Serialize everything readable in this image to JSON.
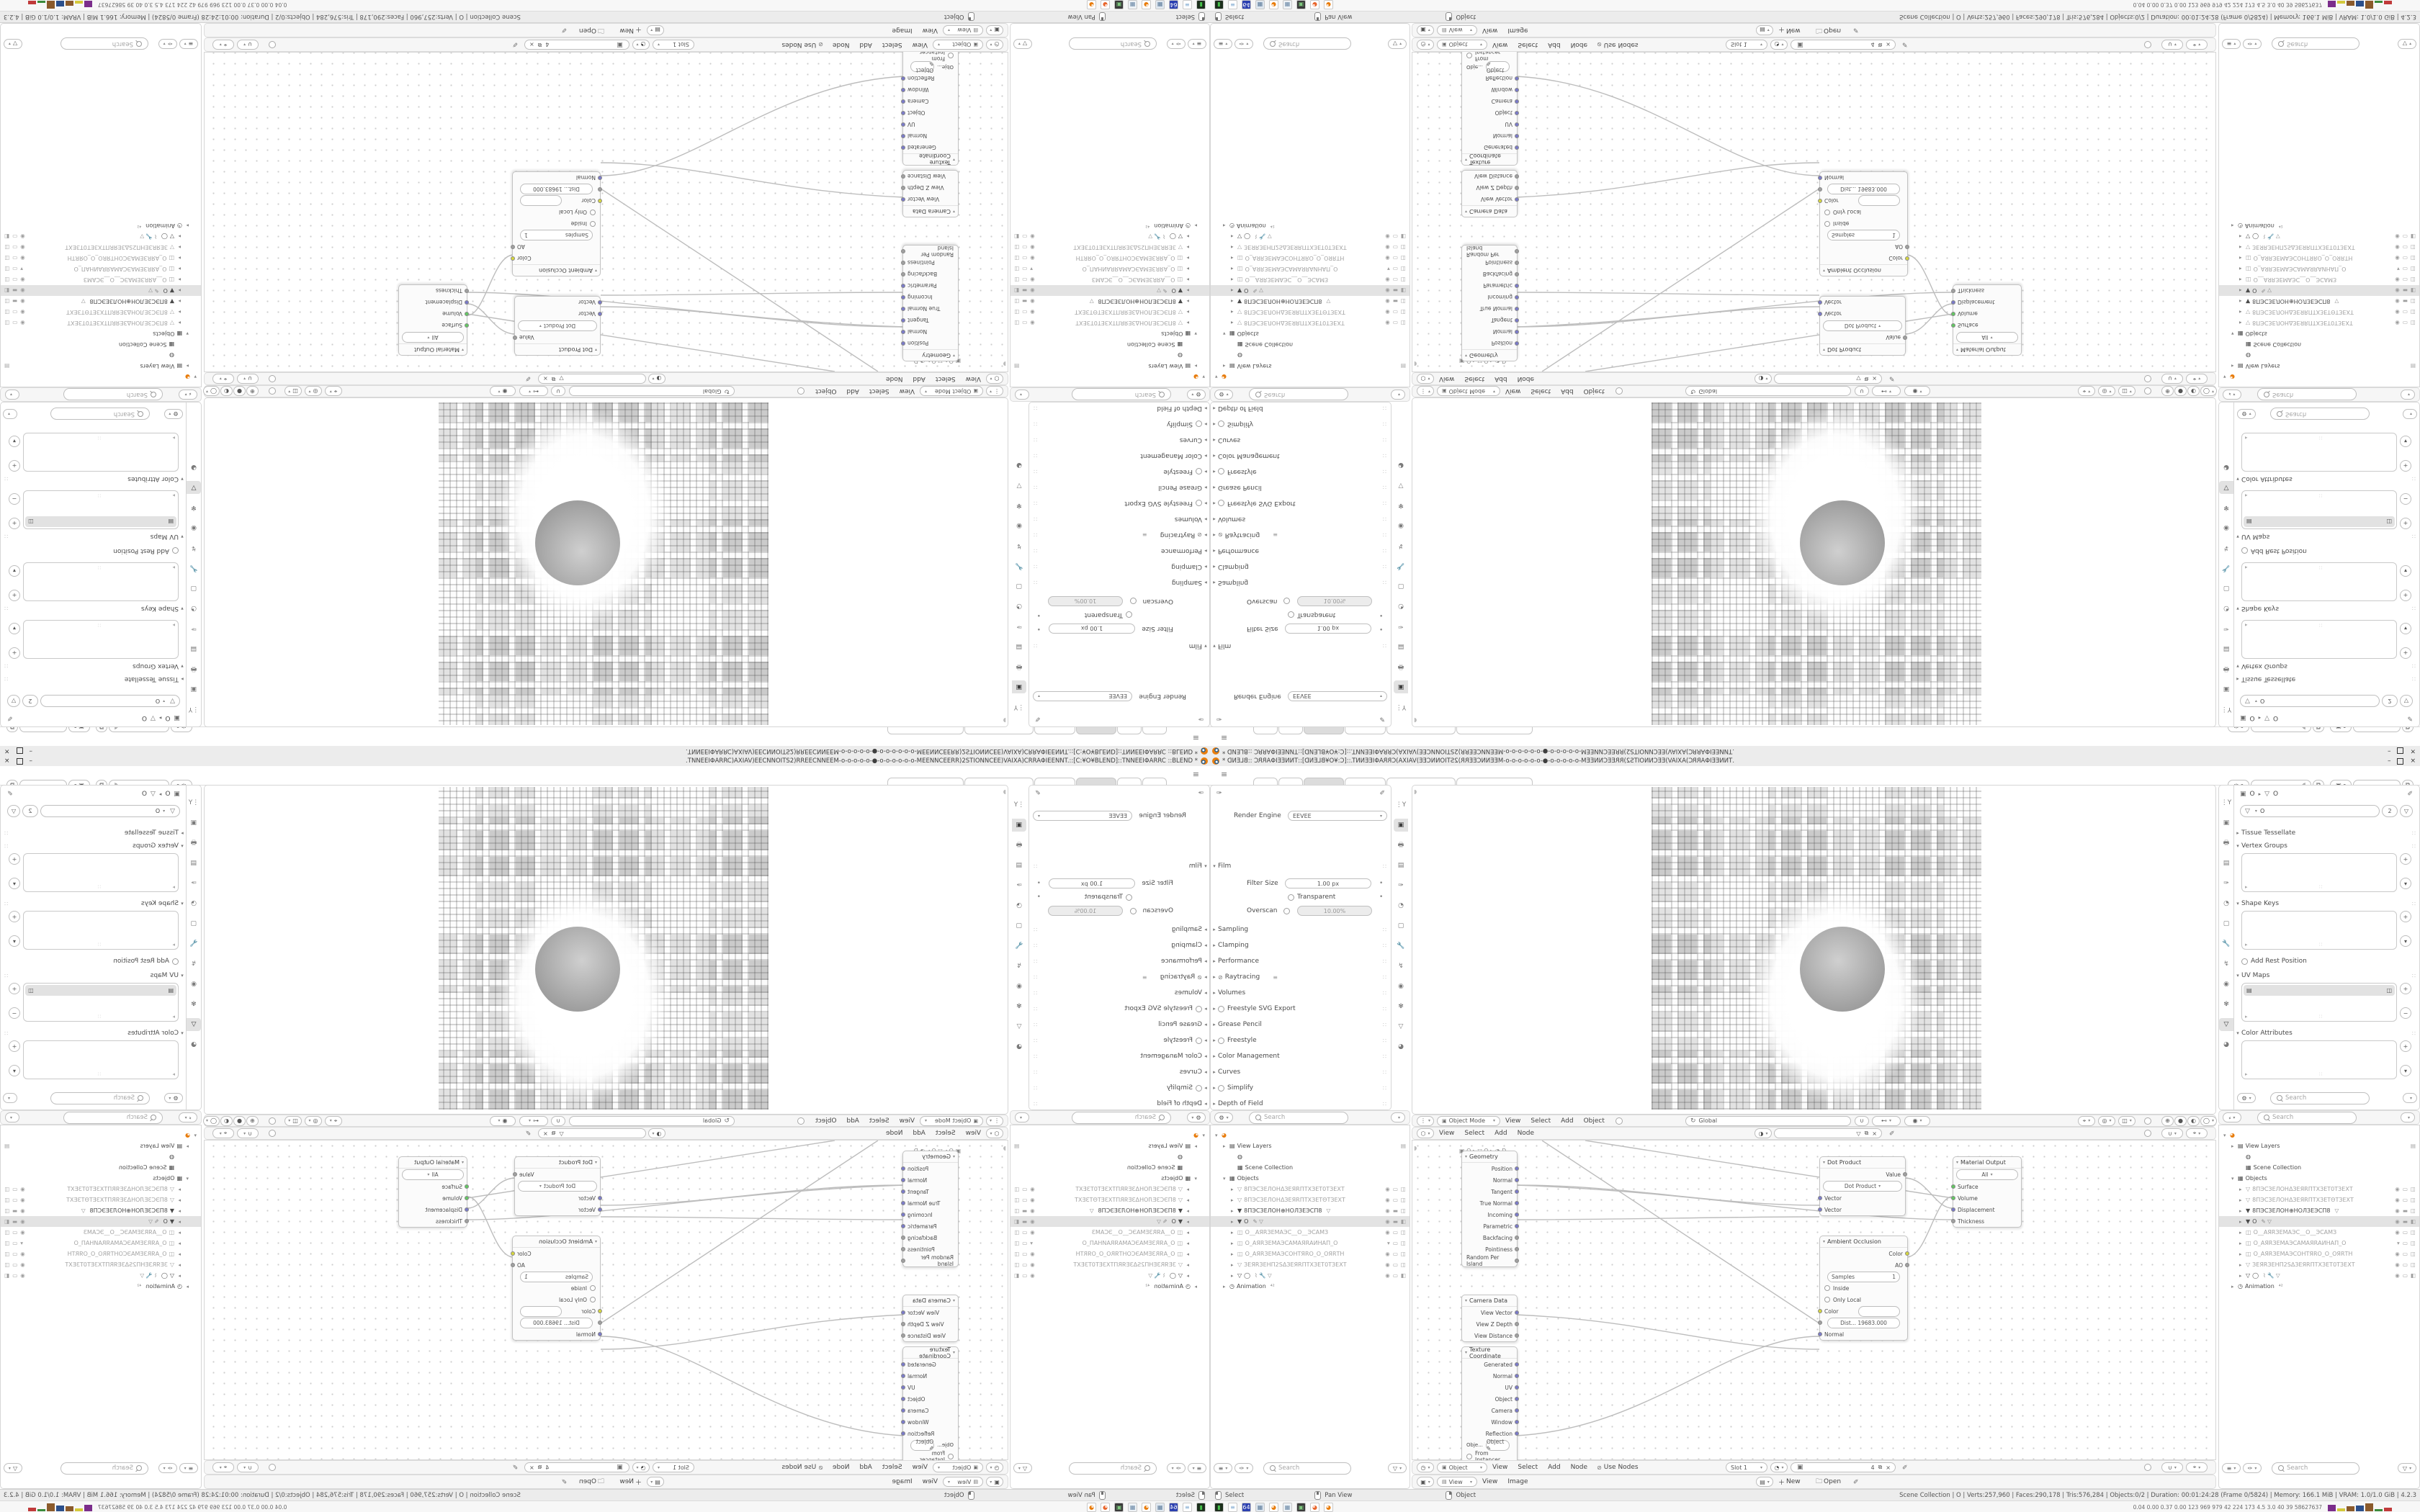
{
  "window": {
    "title_flipped_source": ".TNNEEIΦARRC)AXIAV)EECNNOITS2)RREECNNEEM-o-o-o-o-o-●-o-o-o-o-o-o-MEENNCEERR)2STIONNCEE)VAIXA)CRRAΦIEENNT.::[C:¥O¥BLEND]::TNNEEIΦARRC ::BLEND *",
    "minimize_label": "–",
    "close_label": "×"
  },
  "topbar": {
    "menu_icon": "≡",
    "tabs": {
      "count": 6,
      "active_index": 2,
      "add_label": "+"
    },
    "id_field_1": {
      "icon": "✑",
      "pin": "✐",
      "copy": "⧉"
    },
    "id_field_2": {
      "icon": "▣",
      "copy": "⧉"
    }
  },
  "render_props": {
    "pin_icon": "✐",
    "engine_label": "Render Engine",
    "engine_value": "EEVEE",
    "rows": [
      {
        "t": "open",
        "label": "Film"
      },
      {
        "t": "field",
        "label": "Filter Size",
        "value": "1.00 px"
      },
      {
        "t": "check",
        "label": "Transparent"
      },
      {
        "t": "field2",
        "label": "Overscan",
        "value": "10.00%"
      },
      {
        "t": "panel",
        "label": "Sampling"
      },
      {
        "t": "panel",
        "label": "Clamping"
      },
      {
        "t": "panel",
        "label": "Performance"
      },
      {
        "t": "paneltoggle",
        "label": "Raytracing"
      },
      {
        "t": "panel",
        "label": "Volumes"
      },
      {
        "t": "panelcheck",
        "label": "Freestyle SVG Export"
      },
      {
        "t": "panel",
        "label": "Grease Pencil"
      },
      {
        "t": "panelcheck",
        "label": "Freestyle"
      },
      {
        "t": "panel",
        "label": "Color Management"
      },
      {
        "t": "panel",
        "label": "Curves"
      },
      {
        "t": "panelcheck",
        "label": "Simplify"
      },
      {
        "t": "panel",
        "label": "Depth of Field"
      },
      {
        "t": "panelcheck",
        "label": "Motion Blur"
      }
    ]
  },
  "props_tabs": [
    "⋮Y",
    "▣",
    "🖶",
    "▤",
    "✑",
    "◔",
    "▢",
    "🔧",
    "↯",
    "◉",
    "✾",
    "▽",
    "◕"
  ],
  "props_tabs_active_render": 1,
  "props_tabs_active_data": 11,
  "data_props": {
    "breadcrumb_obj": "O",
    "breadcrumb_data": "O",
    "pin_icon": "✐",
    "name_value": "O",
    "users_count": "2",
    "shield_icon": "▽",
    "panels": [
      {
        "t": "closed",
        "label": "Tissue Tessellate"
      },
      {
        "t": "list",
        "label": "Vertex Groups",
        "item": null,
        "btns": [
          "+",
          "▾"
        ]
      },
      {
        "t": "list",
        "label": "Shape Keys",
        "item": null,
        "btns": [
          "+",
          "▾"
        ]
      },
      {
        "t": "check",
        "label": "Add Rest Position"
      },
      {
        "t": "list",
        "label": "UV Maps",
        "item": "▤",
        "item_trail": "◫",
        "btns": [
          "+",
          "−"
        ]
      },
      {
        "t": "list",
        "label": "Color Attributes",
        "item": null,
        "btns": [
          "+",
          "▾"
        ]
      }
    ],
    "search_placeholder": "Search"
  },
  "outliner": {
    "search_placeholder": "Search",
    "filter_icons": [
      "≡",
      "✑",
      "▽"
    ],
    "items": [
      {
        "depth": 0,
        "arrow": "▾",
        "icon": "◕",
        "icon_color": "#e87d0d",
        "label": "",
        "trail": []
      },
      {
        "depth": 1,
        "arrow": "▸",
        "icon": "▤",
        "label": "View Layers",
        "trail": [
          "▤"
        ]
      },
      {
        "depth": 2,
        "arrow": "",
        "icon": "◍",
        "label": "",
        "trail": []
      },
      {
        "depth": 2,
        "arrow": "",
        "icon": "▦",
        "label": "Scene Collection",
        "trail": []
      },
      {
        "depth": 1,
        "arrow": "▾",
        "icon": "▦",
        "label": "Objects",
        "trail": []
      },
      {
        "depth": 2,
        "arrow": "▸",
        "icon": "▽",
        "label": "8ПЭСЗЕЛОНΔЗЕЯRПТХЗЕТ0ТЗЕХТ",
        "dim": true,
        "trail": [
          "◉",
          "▭",
          "◫"
        ]
      },
      {
        "depth": 2,
        "arrow": "▸",
        "icon": "▽",
        "label": "8ПЭСЗЕЛОНΔЗЕЯRПТХЗЕТΘТЗЕХТ",
        "dim": true,
        "trail": [
          "◉",
          "▭",
          "◫"
        ]
      },
      {
        "depth": 2,
        "arrow": "▸",
        "icon": "▼",
        "label": "8ПЭСЗЕЛОН⊕НОЛЗЕЭСП8",
        "extra": "▽",
        "trail": [
          "◉",
          "▬",
          "◫"
        ]
      },
      {
        "depth": 2,
        "arrow": "▸",
        "icon": "▼",
        "label": "O",
        "sel": true,
        "extra": "✎ ▽",
        "trail": [
          "◉",
          "▬",
          "◧"
        ]
      },
      {
        "depth": 2,
        "arrow": "▸",
        "icon": "◫",
        "label": "O__АЯRЗЕМАЭС__O__ЭСАМЗ",
        "dim": true,
        "trail": [
          "◉",
          "▭",
          "◫"
        ]
      },
      {
        "depth": 2,
        "arrow": "▸",
        "icon": "◫",
        "label": "O_АЯRЗЕМАЭСАМАЯRАИНАП_O",
        "dim": true,
        "trail": [
          "▾",
          "▭",
          "◫"
        ]
      },
      {
        "depth": 2,
        "arrow": "▸",
        "icon": "◫",
        "label": "O_АЯRЗЕМАЭСОНТЯRО_O_ОЯRТН",
        "dim": true,
        "trail": [
          "◉",
          "▭",
          "◫"
        ]
      },
      {
        "depth": 2,
        "arrow": "▸",
        "icon": "▽",
        "label": "ЗЕЯRЗЕНП2SΔЗЕЯRПТХЗЕТ0ТЗЕХТ",
        "dim": true,
        "trail": [
          "◉",
          "▭",
          "◫"
        ]
      },
      {
        "depth": 2,
        "arrow": "▸",
        "icon": "▽",
        "label": "◯",
        "extra": "⌇ 🔧 ▽",
        "trail": [
          "◉",
          "▭",
          "◧"
        ]
      },
      {
        "depth": 1,
        "arrow": "▸",
        "icon": "◷",
        "label": "Animation",
        "extra": "⁴²",
        "trail": []
      }
    ]
  },
  "viewport": {
    "mode_value": "Object Mode",
    "menus": [
      "View",
      "Select",
      "Add",
      "Object"
    ],
    "orientation_value": "Global",
    "orientation_icon": "↻",
    "snap_icons": [
      "∪",
      "⊷",
      "◉"
    ],
    "shading_icons": [
      "⊕",
      "●",
      "◐",
      "◯"
    ],
    "overlay_icons": [
      "💡",
      "◎",
      "🎨"
    ]
  },
  "node_editor": {
    "top_menus": [
      "View",
      "Select",
      "Add",
      "Node"
    ],
    "breadcrumb": "▣ O  ▸  ▽ O  ▸  ◑ D",
    "mat_field_icon": "◑",
    "mat_field_btns": [
      "▽",
      "⧉",
      "×"
    ],
    "bottom": {
      "clock_icon": "◷",
      "mode_value": "Object",
      "menus": [
        "View",
        "Select",
        "Add",
        "Node"
      ],
      "use_nodes_label": "Use Nodes",
      "slot_value": "Slot 1",
      "id_icon": "▣",
      "id_count": "4",
      "id_btns": [
        "⧉",
        "×"
      ]
    },
    "nodes": {
      "geometry": {
        "title": "Geometry",
        "outputs": [
          [
            "Position",
            "vec"
          ],
          [
            "Normal",
            "vec"
          ],
          [
            "Tangent",
            "vec"
          ],
          [
            "True Normal",
            "vec"
          ],
          [
            "Incoming",
            "vec"
          ],
          [
            "Parametric",
            "vec"
          ],
          [
            "Backfacing",
            "val"
          ],
          [
            "Pointiness",
            "val"
          ],
          [
            "Random Per Island",
            "val"
          ]
        ]
      },
      "camera_data": {
        "title": "Camera Data",
        "outputs": [
          [
            "View Vector",
            "vec"
          ],
          [
            "View Z Depth",
            "val"
          ],
          [
            "View Distance",
            "val"
          ]
        ]
      },
      "tex_coord": {
        "title": "Texture Coordinate",
        "outputs": [
          [
            "Generated",
            "vec"
          ],
          [
            "Normal",
            "vec"
          ],
          [
            "UV",
            "vec"
          ],
          [
            "Object",
            "vec"
          ],
          [
            "Camera",
            "vec"
          ],
          [
            "Window",
            "vec"
          ],
          [
            "Reflection",
            "vec"
          ]
        ],
        "field_label": "Obje...",
        "field_value": "Object",
        "check_label": "From Instancer"
      },
      "dot_product": {
        "title": "Dot Product",
        "output": "Value",
        "dropdown": "Dot Product",
        "inputs": [
          [
            "Vector",
            "vec"
          ],
          [
            "Vector",
            "vec"
          ]
        ]
      },
      "material_output": {
        "title": "Material Output",
        "dropdown": "All",
        "inputs": [
          [
            "Surface",
            "shader"
          ],
          [
            "Volume",
            "shader"
          ],
          [
            "Displacement",
            "vec"
          ],
          [
            "Thickness",
            "val"
          ]
        ]
      },
      "ambient_occlusion": {
        "title": "Ambient Occlusion",
        "outputs": [
          [
            "Color",
            "col"
          ],
          [
            "AO",
            "val"
          ]
        ],
        "samples_label": "Samples",
        "samples_value": "1",
        "checks": [
          "Inside",
          "Only Local"
        ],
        "inputs": [
          [
            "Color",
            "col"
          ],
          [
            "Dist...    19683.000",
            "val"
          ],
          [
            "Normal",
            "vec"
          ]
        ]
      }
    }
  },
  "image_editor": {
    "view_value": "View",
    "menus": [
      "View",
      "Image"
    ],
    "new_label": "New",
    "open_label": "Open",
    "pin_icon": "✐"
  },
  "status_bar": {
    "hints": [
      {
        "button": "left",
        "label": "Select"
      },
      {
        "button": "middle",
        "label": "Pan View"
      },
      {
        "button": "right",
        "label": "Object"
      }
    ],
    "info": "Scene Collection | O | Verts:257,960 | Faces:290,178 | Tris:576,284 | Objects:0/2 | Duration: 00:01:24:28 (Frame 0/5824) | Memory: 166.1 MiB | VRAM: 1.0/1.0 GiB | 4.2.3"
  },
  "taskbar": {
    "icons": [
      {
        "name": "terminal-green",
        "bg": "#1c2e1c",
        "fg": "#46c24a",
        "glyph": "▮"
      },
      {
        "name": "notepad",
        "bg": "#ffffff",
        "fg": "#7fa8d0",
        "glyph": "≡"
      },
      {
        "name": "floppy-64",
        "bg": "#2b3fb0",
        "fg": "#ffffff",
        "glyph": "64"
      },
      {
        "name": "calculator",
        "bg": "#dfe7ef",
        "fg": "#5b7a9a",
        "glyph": "▦"
      },
      {
        "name": "blender",
        "bg": "#ffffff",
        "fg": "#e87d0d",
        "glyph": "◕"
      },
      {
        "name": "calculator-2",
        "bg": "#eef2f6",
        "fg": "#6a88a6",
        "glyph": "▦"
      },
      {
        "name": "display-capture",
        "bg": "#3a3a3a",
        "fg": "#7ec87e",
        "glyph": "▣"
      },
      {
        "name": "firefox",
        "bg": "#ffffff",
        "fg": "#e8662c",
        "glyph": "◕"
      },
      {
        "name": "blender-2",
        "bg": "#ffffff",
        "fg": "#e87d0d",
        "glyph": "◕"
      }
    ],
    "monitor_text": "0.04 0.00 0.37 0.00  123  969  979  42  224  173  4.5  3.0  40  39  58627637",
    "graph_bars": [
      {
        "c": "#7b2d8b",
        "h": 9
      },
      {
        "c": "#d4c93a",
        "h": 4
      },
      {
        "c": "#8b5a2b",
        "h": 7
      },
      {
        "c": "#2b4f8b",
        "h": 8
      },
      {
        "c": "#8b5a2b",
        "h": 11
      },
      {
        "c": "#3a8b3a",
        "h": 3
      },
      {
        "c": "#c03a3a",
        "h": 5
      }
    ]
  },
  "socket_colors": {
    "vec": "#7a7ac9",
    "val": "#a0a0a0",
    "col": "#d6d63f",
    "shader": "#63c763"
  }
}
